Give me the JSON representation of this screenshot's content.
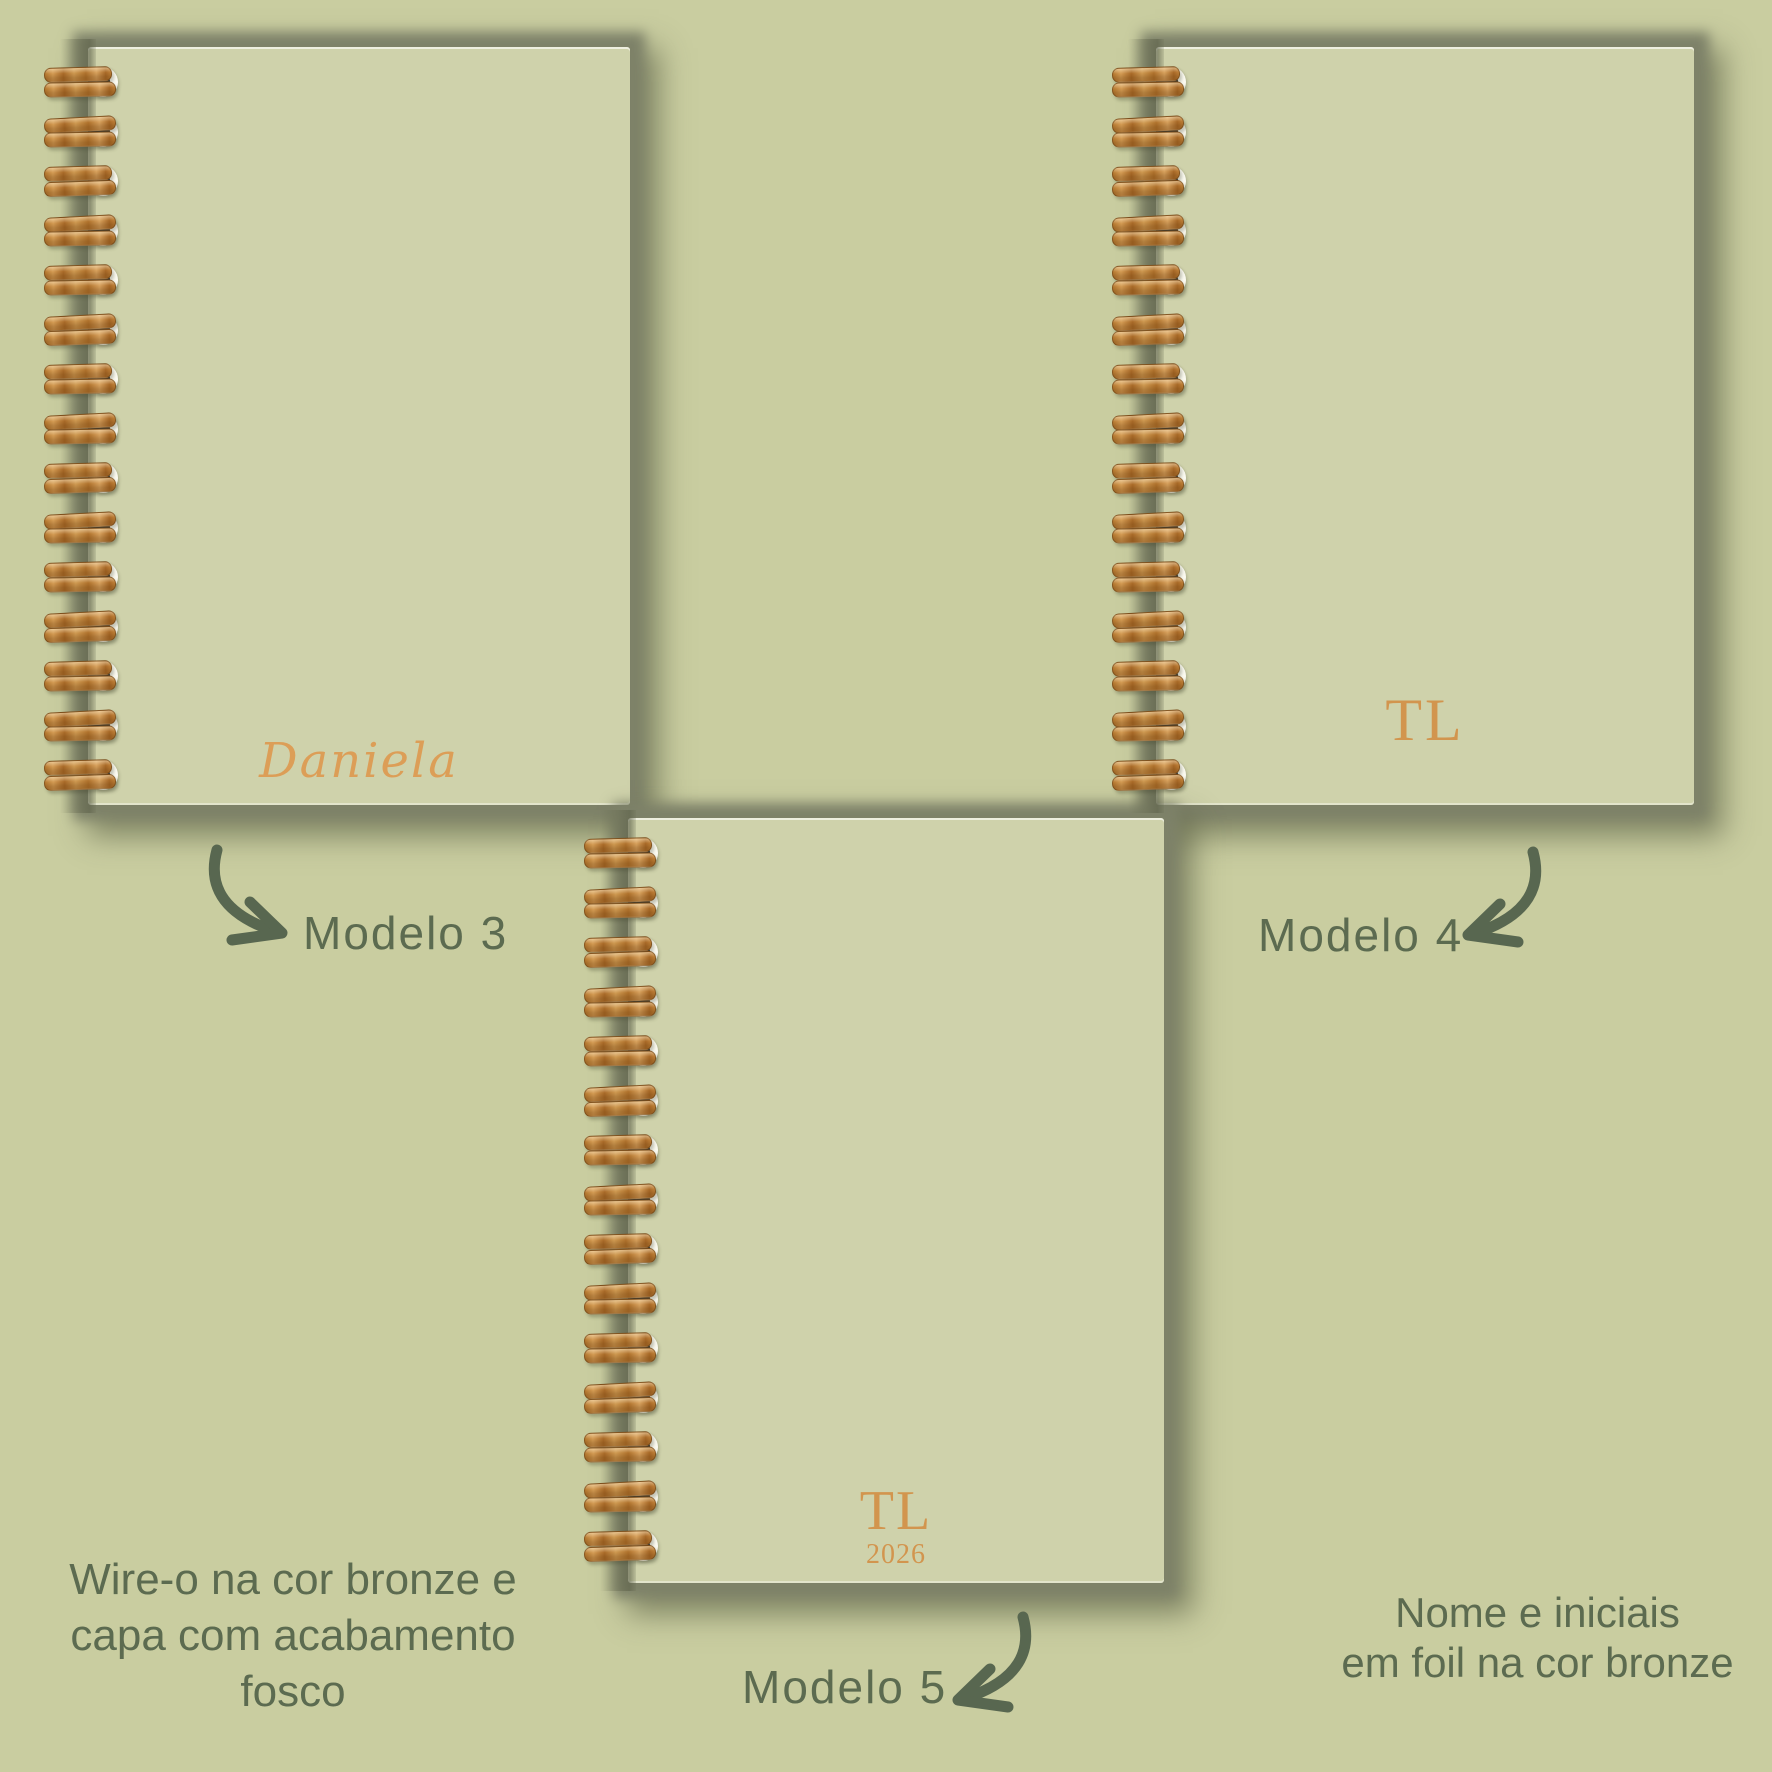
{
  "product_showcase": {
    "notebooks": [
      {
        "id": "modelo-3",
        "cover_name": "Daniela",
        "label": "Modelo 3"
      },
      {
        "id": "modelo-4",
        "cover_initials": "TL",
        "label": "Modelo 4"
      },
      {
        "id": "modelo-5",
        "cover_initials": "TL",
        "cover_year": "2026",
        "label": "Modelo 5"
      }
    ],
    "captions": {
      "wireo_lines": [
        "Wire-o na cor bronze e",
        "capa com acabamento",
        "fosco"
      ],
      "foil_lines": [
        "Nome e iniciais",
        "em foil na cor bronze"
      ]
    },
    "colors": {
      "background": "#c9cda0",
      "cover": "#cfd2ab",
      "shadow_band": "#7d8168",
      "text_green": "#5c6b50",
      "arrow_green": "#586750",
      "foil_bronze": "#d2954e",
      "script_bronze": "#dc9e57",
      "wire_bronze": "#b87d3c"
    }
  }
}
